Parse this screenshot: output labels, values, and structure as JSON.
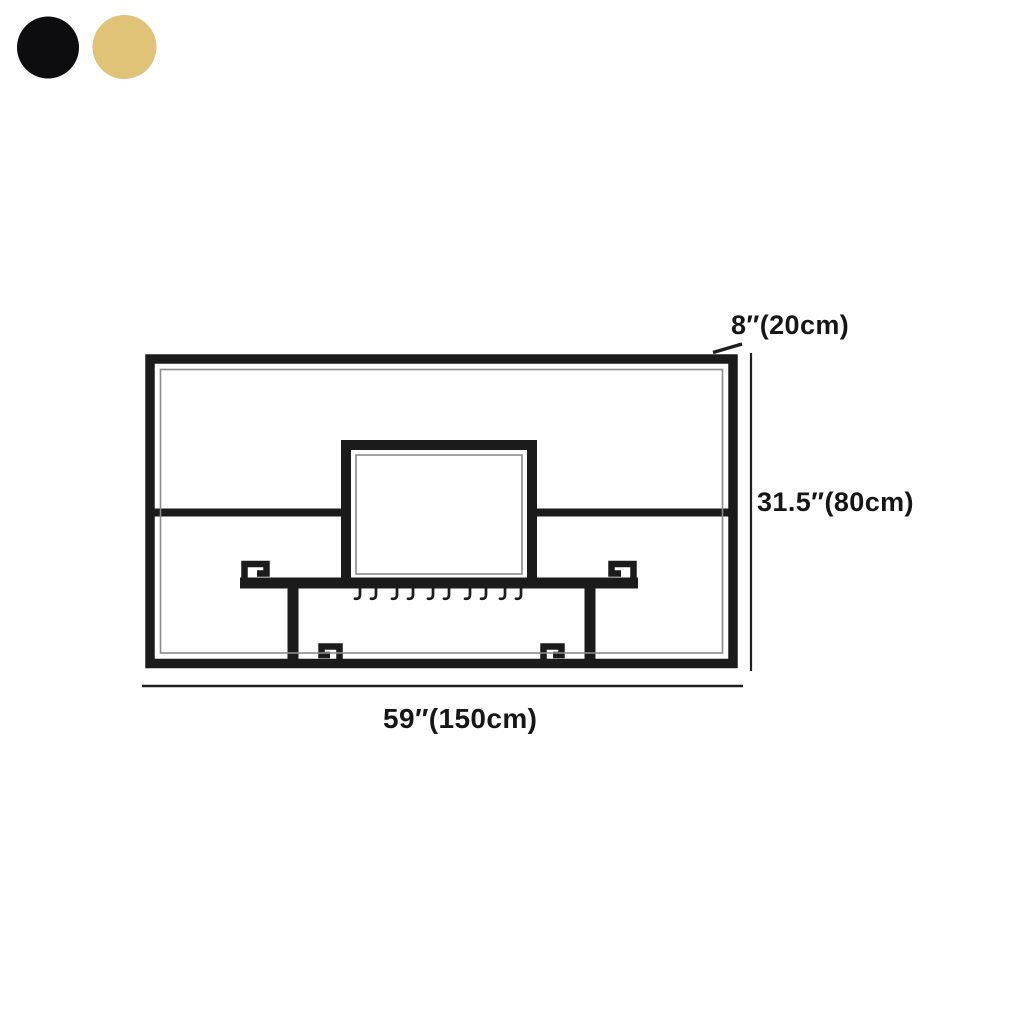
{
  "swatches": [
    {
      "name": "black",
      "color": "#0d0d10"
    },
    {
      "name": "gold",
      "color": "#e0c377"
    }
  ],
  "labels": {
    "depth": "8″(20cm)",
    "height": "31.5″(80cm)",
    "width": "59″(150cm)"
  },
  "colors": {
    "line": "#1b1b1b",
    "dimension_line": "#1f1f1f",
    "label_text": "#161616"
  },
  "diagram": {
    "description": "Dimension drawing of a wall-mounted rack: outer rectangular frame, middle shelf rail, raised center compartment, two posts with greek-key accents, and a row of stemware hooks",
    "hook_count": 10
  }
}
